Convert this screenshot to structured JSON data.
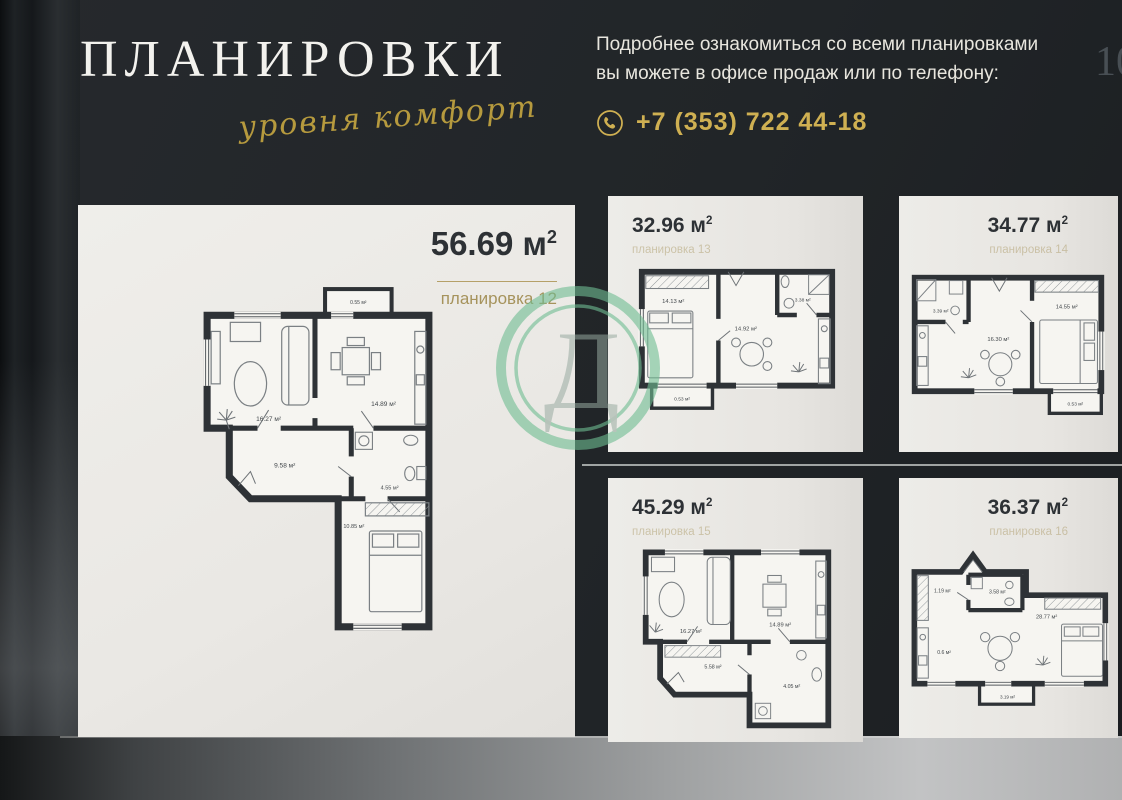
{
  "header": {
    "title": "ПЛАНИРОВКИ",
    "tagline": "уровня комфорт",
    "info_line1": "Подробнее ознакомиться со всеми планировками",
    "info_line2": "вы можете в офисе продаж или по телефону:",
    "phone": "+7 (353) 722 44-18",
    "page_number": "10"
  },
  "watermark": {
    "letter": "Д"
  },
  "colors": {
    "background": "#212528",
    "card": "#ecebe7",
    "gold": "#c2a44e",
    "wall": "#2e3236",
    "watermark_green": "#6fbd92",
    "text_light": "#e8e6de",
    "text_dark": "#2d3135"
  },
  "plans": [
    {
      "area": "56.69",
      "unit": "м",
      "unit_sup": "2",
      "label": "планировка 12",
      "rooms": [
        {
          "label": "0.55 м²"
        },
        {
          "label": "16.27 м²"
        },
        {
          "label": "14.89 м²"
        },
        {
          "label": "9.58 м²"
        },
        {
          "label": "4.55 м²"
        },
        {
          "label": "10.85 м²"
        }
      ]
    },
    {
      "area": "32.96",
      "unit": "м",
      "unit_sup": "2",
      "label": "планировка 13",
      "rooms": [
        {
          "label": "14.13 м²"
        },
        {
          "label": "14.92 м²"
        },
        {
          "label": "3.38 м²"
        },
        {
          "label": "0.53 м²"
        }
      ]
    },
    {
      "area": "34.77",
      "unit": "м",
      "unit_sup": "2",
      "label": "планировка 14",
      "rooms": [
        {
          "label": "3.39 м²"
        },
        {
          "label": "16.30 м²"
        },
        {
          "label": "14.55 м²"
        },
        {
          "label": "0.53 м²"
        }
      ]
    },
    {
      "area": "45.29",
      "unit": "м",
      "unit_sup": "2",
      "label": "планировка 15",
      "rooms": [
        {
          "label": "16.27 м²"
        },
        {
          "label": "14.89 м²"
        },
        {
          "label": "5.58 м²"
        },
        {
          "label": "4.05 м²"
        }
      ]
    },
    {
      "area": "36.37",
      "unit": "м",
      "unit_sup": "2",
      "label": "планировка 16",
      "rooms": [
        {
          "label": "1.19 м²"
        },
        {
          "label": "3.58 м²"
        },
        {
          "label": "28.77 м²"
        },
        {
          "label": "0.6 м²"
        },
        {
          "label": "3.19 м²"
        }
      ]
    }
  ]
}
